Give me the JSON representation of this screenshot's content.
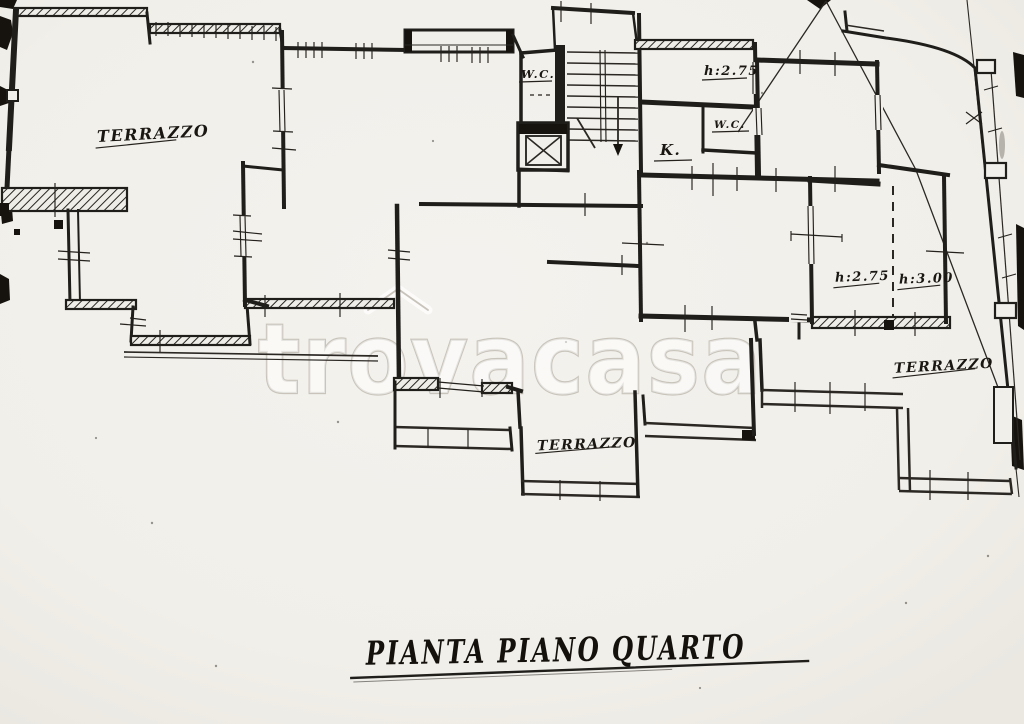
{
  "page": {
    "paper_color": "#f1efe9",
    "ink_color": "#1c1a17",
    "watermark_color": "#c8c4bb"
  },
  "plan": {
    "title": "PIANTA PIANO QUARTO",
    "watermark": "trovacasa",
    "labels": {
      "terrace_top_left": "TERRAZZO",
      "stair_wc": "W.C.",
      "top_room_height": "h:2.75",
      "kitchen": "K.",
      "small_wc": "W.C.",
      "right_room_height_a": "h:2.75",
      "right_room_height_b": "h:3.00",
      "terrace_right": "TERRAZZO",
      "terrace_bottom": "TERRAZZO"
    }
  }
}
